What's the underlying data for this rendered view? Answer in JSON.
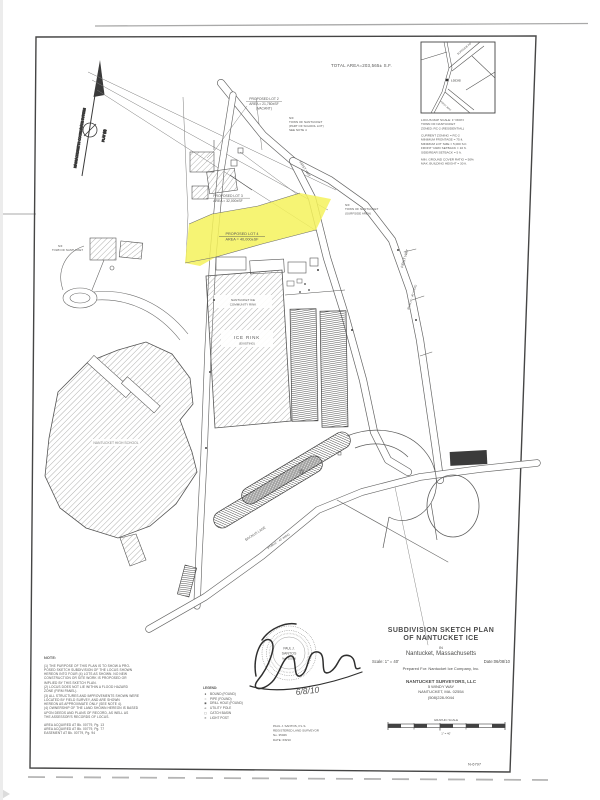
{
  "header": {
    "total_area": "TOTAL AREA=203,565± S.F.",
    "plan_number": "N-6797"
  },
  "north": {
    "left": "MASSACHUSETTS COORDINATE SYSTEM",
    "right": "PLAT (M)"
  },
  "locus": {
    "mark": "LOCUS",
    "road1": "SURFSIDE RD",
    "road2": "FIRST WAY",
    "block1": [
      "LOCUS MAP  SCALE: 1\"=600'±",
      "TOWN OF NANTUCKET",
      "ZONED: RC-2 (RESIDENTIAL)"
    ],
    "block2": [
      "CURRENT ZONING = RC-2",
      "MINIMUM FRONTAGE = 75 ft.",
      "MINIMUM LOT SIZE = 5,000 S.F.",
      "FRONT YARD SETBACK = 10 ft.",
      "SIDE/REAR SETBACK = 5 ft."
    ],
    "block3": [
      "MIN. GROUND COVER RATIO = 50%",
      "MAX. BUILDING HEIGHT = 30 ft."
    ]
  },
  "lots": {
    "lot2": [
      "PROPOSED LOT 2",
      "AREA = 21,780±SF",
      "(VACANT)"
    ],
    "lot3": [
      "PROPOSED LOT 3",
      "AREA = 32,000±SF"
    ],
    "lot4": [
      "PROPOSED LOT 4",
      "AREA = 40,000±SF"
    ]
  },
  "labels": {
    "nf_top": [
      "N/F",
      "TOWN OF NANTUCKET",
      "(PART OF SCHOOL LOT)",
      "SEE NOTE 4"
    ],
    "nf_right": [
      "N/F",
      "TOWN OF NANTUCKET",
      "(SURFSIDE AREA)"
    ],
    "nf_left": [
      "N/F",
      "TOWN OF NANTUCKET"
    ],
    "rink_top": [
      "NANTUCKET ICE",
      "COMMUNITY RINK"
    ],
    "rink": [
      "ICE RINK",
      "(EXISTING)"
    ],
    "school": "NANTUCKET HIGH SCHOOL",
    "road_upper": "FIRST WAY",
    "road_right": "FIRST WAY",
    "road_right_sub": "(PUBLIC - 40' WIDE)",
    "road_bottom": "BACKUS LANE",
    "road_bottom_sub": "(PUBLIC - 40' WIDE)"
  },
  "legend": {
    "title": "LEGEND:",
    "items": [
      {
        "symbol": "●",
        "label": "BOUND (FOUND)"
      },
      {
        "symbol": "○",
        "label": "PIPE (FOUND)"
      },
      {
        "symbol": "◉",
        "label": "DRILL HOLE (FOUND)"
      },
      {
        "symbol": "⌀",
        "label": "UTILITY POLE"
      },
      {
        "symbol": "▢",
        "label": "CATCH BASIN"
      },
      {
        "symbol": "✕",
        "label": "LIGHT POST"
      }
    ]
  },
  "notes": {
    "title": "NOTE:",
    "lines": [
      "(1) THE PURPOSE OF THIS PLAN IS TO SHOW A PRO-",
      "POSED SKETCH SUBDIVISION OF THE LOCUS SHOWN",
      "HEREON INTO FOUR (4) LOTS AS SHOWN. NO NEW",
      "CONSTRUCTION OR SITE WORK IS PROPOSED OR",
      "IMPLIED BY THIS SKETCH PLAN.",
      "(2) LOCUS DOES NOT LIE WITHIN A FLOOD HAZARD",
      "ZONE (FIRM PANEL).",
      "(3) ALL STRUCTURES AND IMPROVEMENTS SHOWN WERE",
      "LOCATED BY FIELD SURVEY, AND ARE SHOWN",
      "HEREON AS APPROXIMATE ONLY (SEE NOTE 4).",
      "(4) OWNERSHIP OF THE LAND SHOWN HEREON IS BASED",
      "UPON DEEDS AND PLANS OF RECORD, AS WELL AS",
      "THE ASSESSOR'S RECORDS OF LOCUS."
    ],
    "refs": [
      "AREA ACQUIRED AT Bk. 00779, Pg. 13",
      "AREA ACQUIRED AT Bk. 00779, Pg. 77",
      "EASEMENT AT Bk. 00779, Pg. 94"
    ]
  },
  "stamp": {
    "name_top": "PAUL J.",
    "name_bottom": "SANTOS",
    "number": "No. 35026",
    "date": "6/8/10"
  },
  "certification": [
    "PAUL J. SANTOS, P.L.S.",
    "REGISTERED LAND SURVEYOR",
    "No. 35026",
    "DATE: 6/8/10"
  ],
  "title_block": {
    "line1": "SUBDIVISION SKETCH PLAN",
    "line2": "OF NANTUCKET ICE",
    "in": "IN",
    "town": "Nantucket, Massachusetts",
    "scale": "Scale: 1\" = 40'",
    "date": "Date:06/08/10",
    "prepared": "Prepared For: Nantucket Ice Company, Inc.",
    "firm": "NANTUCKET SURVEYORS, LLC",
    "address1": "5 WINDY WAY",
    "address2": "NANTUCKET, MA. 02554",
    "phone": "(508)228-9044",
    "graphic_scale": "GRAPHIC SCALE",
    "scale_note": "1\" = 40'"
  },
  "colors": {
    "highlight": "#f1ee5c",
    "ink": "#4a4a4a"
  }
}
